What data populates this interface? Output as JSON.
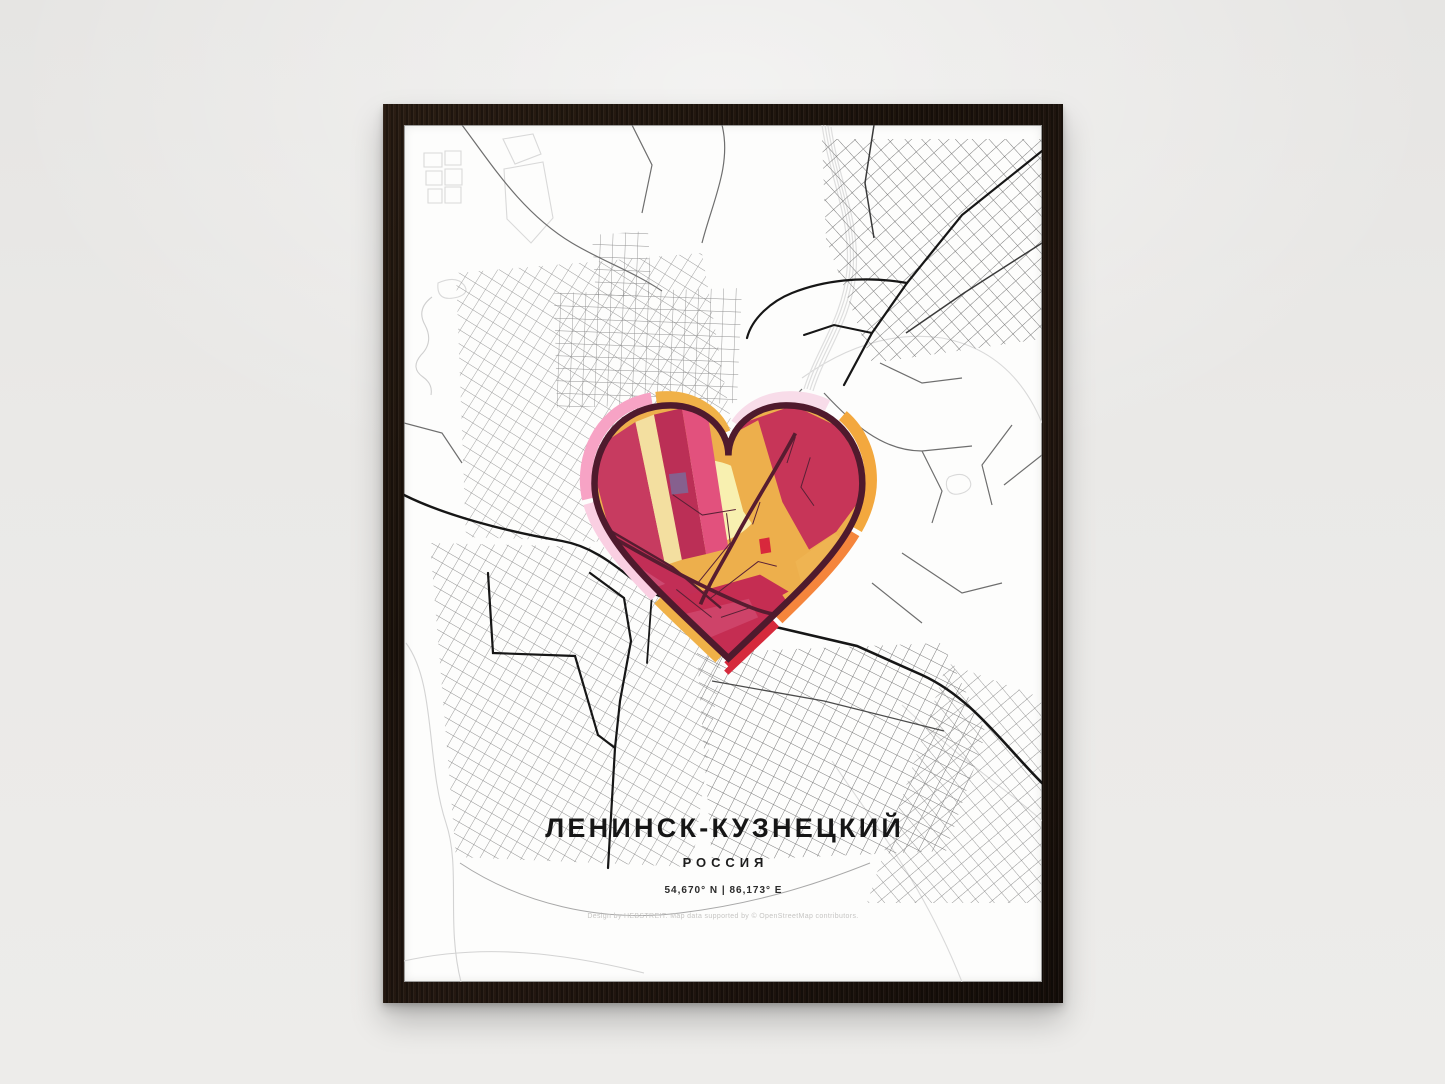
{
  "poster": {
    "title": "ЛЕНИНСК-КУЗНЕЦКИЙ",
    "country": "РОССИЯ",
    "coordinates": "54,670° N | 86,173° E",
    "attribution": "Design by HEBSTREIT. Map data supported by © OpenStreetMap contributors."
  },
  "colors": {
    "wall": "#eae9e7",
    "frame_wood": "#1f160f",
    "paper": "#fdfdfc",
    "street_light": "#d9d9d9",
    "street_minor": "#8f8f8f",
    "street_medium": "#6e6e6e",
    "street_major": "#161616",
    "heart_outline": "#4f1a2d",
    "heart_road": "#571c30",
    "heart_gold": "#edaf4c",
    "heart_cream": "#f8f0b0",
    "heart_crimson": "#c73558",
    "heart_magenta": "#c22e56",
    "heart_pink_stripe": "#e2517d",
    "heart_purple": "#86608e",
    "ring_gold": "#f0b148",
    "ring_gold2": "#f3a83e",
    "ring_pink": "#f7a3c5",
    "ring_lightpink": "#facfe2",
    "ring_palepink": "#f8dce9",
    "ring_orange": "#f5853c",
    "ring_red": "#d62a3c"
  }
}
